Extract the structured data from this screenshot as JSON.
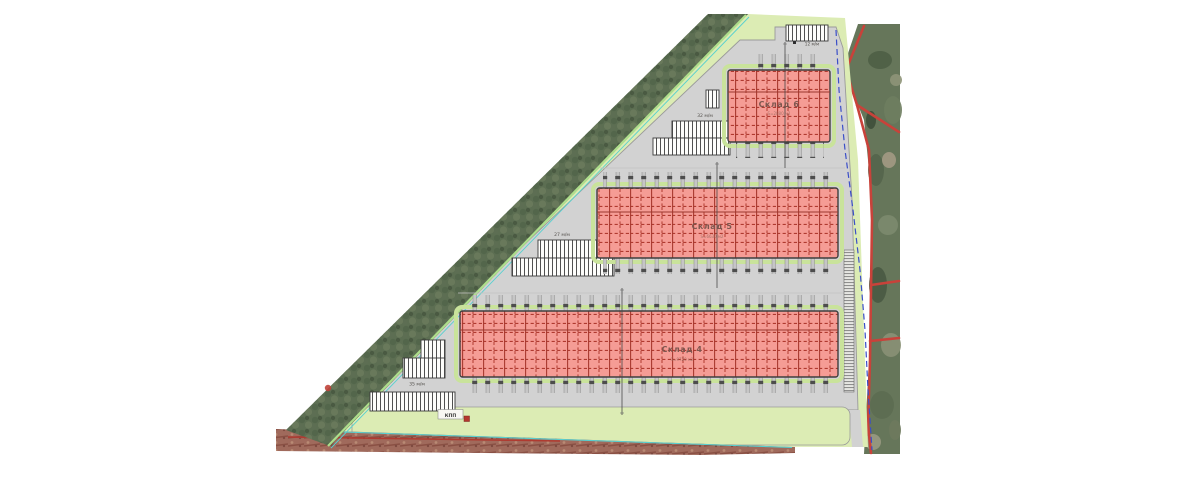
{
  "plan": {
    "drawing_type": "site-plan",
    "buildings": [
      {
        "id": "sklad-6",
        "label": "Склад 6",
        "area_label": "S=2880 м2"
      },
      {
        "id": "sklad-5",
        "label": "Склад 5",
        "area_label": "S=6630 м2"
      },
      {
        "id": "sklad-4",
        "label": "Склад 4",
        "area_label": "S=9720 м2"
      }
    ],
    "parking": [
      {
        "id": "p-top-entry",
        "label": "12 м/м"
      },
      {
        "id": "p-north",
        "label": "32 м/м"
      },
      {
        "id": "p-middle",
        "label": "27 м/м"
      },
      {
        "id": "p-south",
        "label": "35 м/м"
      }
    ],
    "checkpoint_label": "КПП",
    "colors": {
      "paving": "#d2d2d2",
      "lawn": "#dcecb4",
      "building_fill": "#f59c95",
      "building_grid": "#b03a30",
      "trees": "#5c6e52",
      "satellite": "#66765a",
      "road": "#a06a5c",
      "boundary_red": "#c8423a",
      "boundary_blue": "#3a4ec8",
      "edge_cyan": "#58d0d0",
      "edge_lightgreen": "#aede8c"
    }
  }
}
